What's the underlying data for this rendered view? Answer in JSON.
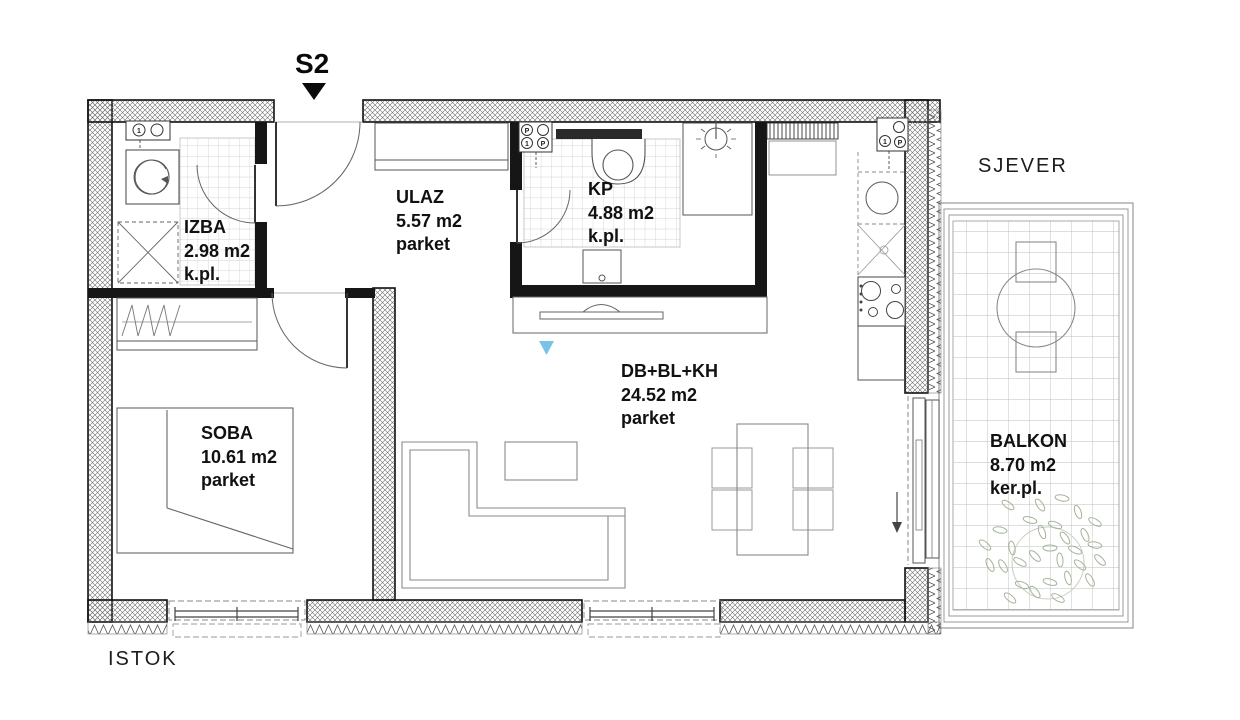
{
  "plan": {
    "unit": {
      "label": "S2"
    },
    "compass": {
      "north": "SJEVER",
      "east": "ISTOK"
    },
    "rooms": [
      {
        "key": "izba",
        "name": "IZBA",
        "area": "2.98 m2",
        "floor": "k.pl."
      },
      {
        "key": "ulaz",
        "name": "ULAZ",
        "area": "5.57 m2",
        "floor": "parket"
      },
      {
        "key": "kp",
        "name": "KP",
        "area": "4.88 m2",
        "floor": "k.pl."
      },
      {
        "key": "soba",
        "name": "SOBA",
        "area": "10.61 m2",
        "floor": "parket"
      },
      {
        "key": "living",
        "name": "DB+BL+KH",
        "area": "24.52 m2",
        "floor": "parket"
      },
      {
        "key": "balkon",
        "name": "BALKON",
        "area": "8.70 m2",
        "floor": "ker.pl."
      }
    ],
    "meters": {
      "izba": [
        "1"
      ],
      "kp": [
        "P",
        "1",
        "P"
      ],
      "kitchen": [
        "1",
        "P"
      ]
    },
    "colors": {
      "wall_line": "#111111",
      "furniture_line": "#8a8a8a",
      "fixture_line": "#555555",
      "tile_line": "#c6c6c6",
      "plant_green": "#a3b49a",
      "marker_blue": "#7ac3e6"
    }
  }
}
